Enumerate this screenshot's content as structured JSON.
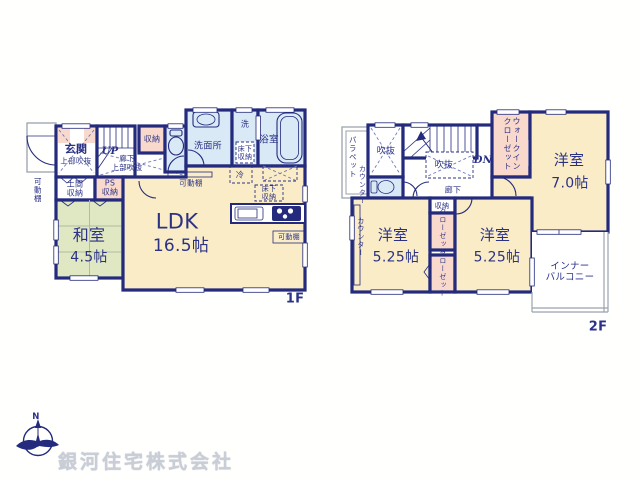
{
  "colors": {
    "wall": "#242b7d",
    "label_text": "#2b3286",
    "ldk_floor": "#f9ecc6",
    "tatami_floor": "#dfe7c3",
    "closet_pink": "#f8d9cc",
    "wet_blue": "#d9e9f5",
    "rail_gray": "#9aa2ae",
    "company_gray": "#c9cdd6"
  },
  "f1": {
    "label": "1F",
    "rooms": {
      "kadodana_left": "可動棚",
      "genkan": "玄関",
      "genkan_sub": "上部吹抜",
      "up": "UP",
      "shuno": "収納",
      "roka": "廊下\n上部吹抜",
      "doma": "土間\n収納",
      "ps": "PS\n収納",
      "senmenjo": "洗面所",
      "sen": "洗",
      "yukashita_a": "床下\n収納",
      "yokushitsu": "浴室",
      "kadodana_mid": "可動棚",
      "rei": "冷",
      "yukashita_b": "床下\n収納",
      "kadodana_kitchen": "可動棚",
      "ldk": "LDK",
      "ldk_size": "16.5帖",
      "washitsu": "和室",
      "washitsu_size": "4.5帖"
    }
  },
  "f2": {
    "label": "2F",
    "rooms": {
      "parapet": "パラペット",
      "counter_a": "カウンター",
      "fukinuke_a": "吹抜",
      "fukinuke_b": "吹抜",
      "dn": "DN",
      "roka": "廊下",
      "wic": "ウォークイン\nクローゼット",
      "yoshitsu7": "洋室",
      "yoshitsu7_size": "7.0帖",
      "counter_b": "カウンター",
      "bed_a": "洋室",
      "bed_a_size": "5.25帖",
      "shuno": "収納",
      "closet_a": "クローゼット",
      "closet_b": "クローゼット",
      "bed_b": "洋室",
      "bed_b_size": "5.25帖",
      "balcony": "インナー\nバルコニー"
    }
  },
  "footer": {
    "compass_n": "N",
    "company": "銀河住宅株式会社"
  }
}
